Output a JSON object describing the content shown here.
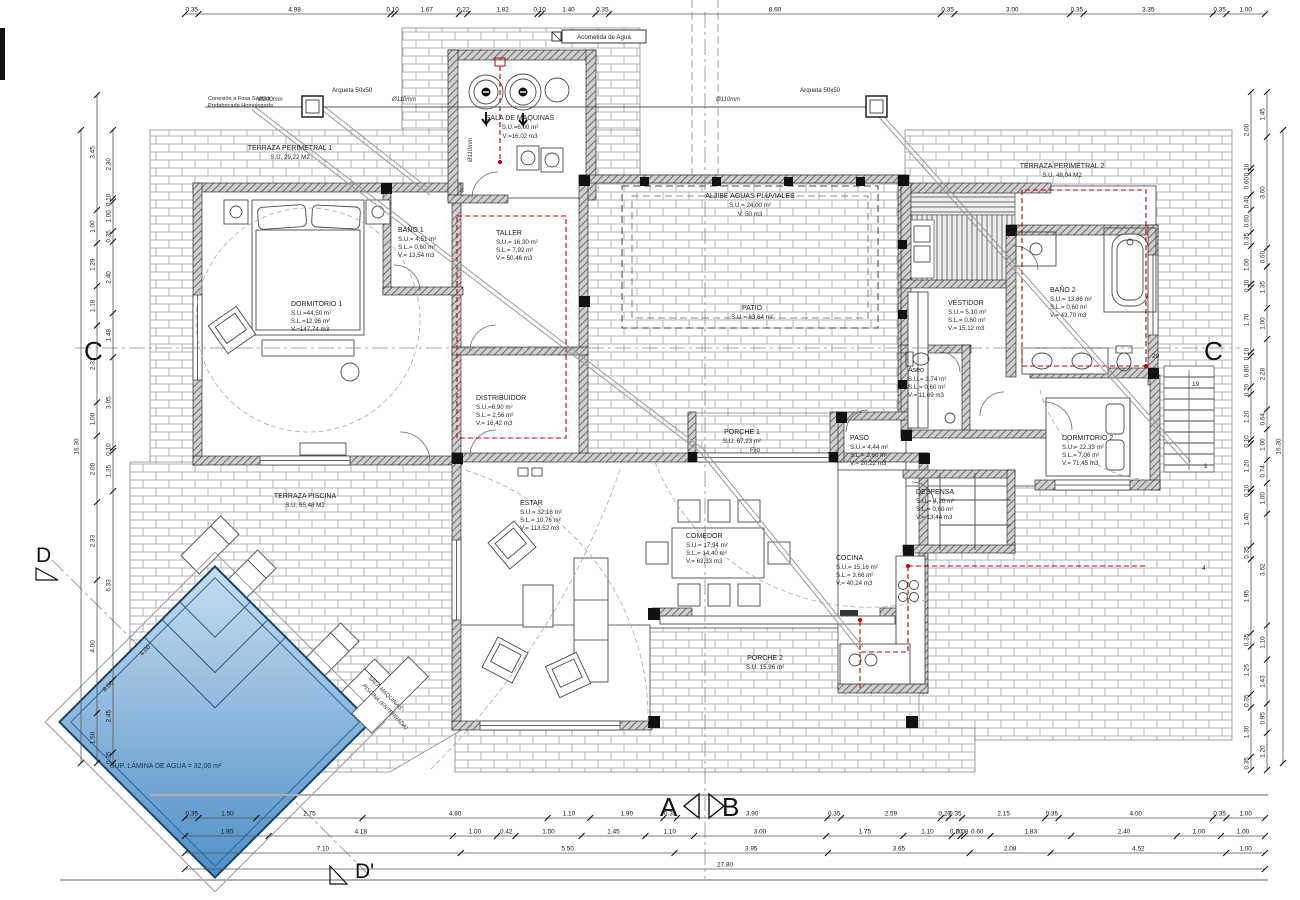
{
  "rooms": [
    {
      "name": "SALA DE MAQUINAS",
      "a": "S.U.=6,00 m²",
      "b": "V:=16,02 m3"
    },
    {
      "name": "TERRAZA PERIMETRAL 1",
      "a": "S.U. 29,22 M2"
    },
    {
      "name": "DORMITORIO 1",
      "a": "S.U.=44,50 m²",
      "b": "S.L.=12,96 m²",
      "c": "V.=147,74 m3"
    },
    {
      "name": "BAÑO 1",
      "a": "S.U.= 4,51 m²",
      "b": "S.L.= 0,60 m²",
      "c": "V.= 13,54 m3"
    },
    {
      "name": "TALLER",
      "a": "S.U.= 16,30 m²",
      "b": "S.L.= 7,92 m²",
      "c": "V.= 50,46 m3"
    },
    {
      "name": "ALJIBE AGUAS PLUVIALES",
      "a": "S.U.= 24,00 m²",
      "b": "V: 50 m3"
    },
    {
      "name": "PATIO",
      "a": "S.U.= 63,64 m²"
    },
    {
      "name": "DISTRIBUIDOR",
      "a": "S.U.=6,90 m²",
      "b": "S.L.= 2,56 m²",
      "c": "V.= 16,42 m3"
    },
    {
      "name": "VESTIDOR",
      "a": "S.U.= 5,10 m²",
      "b": "S.L.= 0,60 m²",
      "c": "V.= 15,12 m3"
    },
    {
      "name": "BAÑO 2",
      "a": "S.U.= 13,86 m²",
      "b": "S.L.= 0,60 m²",
      "c": "V.= 43,70 m3"
    },
    {
      "name": "Aseo",
      "a": "S.U.= 3,74 m²",
      "b": "S.L.= 0,60 m²",
      "c": "V.= 11,69 m3"
    },
    {
      "name": "PASO",
      "a": "S.U.= 4,44 m²",
      "b": "S.L.= 3,60 m²",
      "c": "V.= 20,22 m3"
    },
    {
      "name": "DESPENSA",
      "a": "S.U.= 4,20 m²",
      "b": "S.L.= 0,60 m²",
      "c": "V.= 13,44 m3"
    },
    {
      "name": "DORMITORIO 2",
      "a": "S.U.= 22,33 m²",
      "b": "S.L.= 7,06 m²",
      "c": "V.= 71,45 m3"
    },
    {
      "name": "COCINA",
      "a": "S.U.= 15,16 m²",
      "b": "S.L.= 3,66 m²",
      "c": "V.= 40,24 m3"
    },
    {
      "name": "ESTAR",
      "a": "S.U.= 32,16 m²",
      "b": "S.L.= 10,76 m²",
      "c": "V.= 113,52 m3"
    },
    {
      "name": "COMEDOR",
      "a": "S.U.= 17,94 m²",
      "b": "S.L.= 14,40 m²",
      "c": "V.= 63,33 m3"
    },
    {
      "name": "PORCHE 1",
      "a": "S.U. 67,23 m²"
    },
    {
      "name": "PORCHE 2",
      "a": "S.U. 15,96 m²"
    },
    {
      "name": "TERRAZA PERIMETRAL 2",
      "a": "S.U. 48,04 M2"
    },
    {
      "name": "TERRAZA PISCINA",
      "a": "S.U. 65,48 M2"
    }
  ],
  "annotations": {
    "acometida": "Acometida de Agua",
    "fosa1": "Conexión a Fosa Séptica",
    "fosa2": "Prefabricada Homologada",
    "arqueta": "Arqueta 50x50",
    "d200": "Ø200mm",
    "d110": "Ø110mm",
    "fijo": "Fijo",
    "lamina": "SUP. LÁMINA DE AGUA = 32,00 m²",
    "sala_piscina1": "SALA MAQUINAS",
    "sala_piscina2": "PISCINA (ENTERRADA)"
  },
  "markers": {
    "a": "A",
    "b": "B",
    "c": "C",
    "d": "D",
    "dp": "D'"
  },
  "stairs": [
    "20",
    "19",
    "1",
    "4"
  ],
  "colors": {
    "pool_dark": "#4d8fc7",
    "pool_light": "#c7ddf0",
    "red": "#c00000"
  },
  "dimensions": {
    "top": [
      "0.35",
      "4.98",
      "0.10",
      "1.67",
      "0.22",
      "1.82",
      "0.10",
      "1.40",
      "0.35",
      "8.60",
      "0.35",
      "3.00",
      "0.35",
      "3.35",
      "0.35",
      "1.00"
    ],
    "bottom1": [
      "0.35",
      "1.50",
      "2.75",
      "4.80",
      "1.10",
      "1.90",
      "0.35",
      "3.90",
      "0.35",
      "2.59",
      "0.20",
      "0.35",
      "2.15",
      "0.35",
      "4.00",
      "0.35",
      "1.00"
    ],
    "bottom2": [
      "1.90",
      "4.18",
      "1.00",
      "0.42",
      "1.50",
      "1.45",
      "1.10",
      "3.00",
      "1.75",
      "1.10",
      "0.20",
      "0.08",
      "0.60",
      "1.83",
      "2.40",
      "1.00",
      "1.00"
    ],
    "bottom3": [
      "7.10",
      "5.50",
      "3.95",
      "3.65",
      "2.08",
      "4.52",
      "1.00"
    ],
    "bottom4": [
      "27.80"
    ],
    "left_outer": [
      "16.30"
    ],
    "left_mid": [
      "3.45",
      "1.00",
      "1.29",
      "1.18",
      "2.31",
      "1.00",
      "2.00",
      "2.33",
      "4.00",
      "1.50"
    ],
    "left_inner": [
      "2.30",
      "0.10",
      "1.00",
      "0.35",
      "2.40",
      "1.48",
      "3.05",
      "0.10",
      "1.35",
      "6.33",
      "2.45",
      "0.35"
    ],
    "right_inner": [
      "2.00",
      "0.10",
      "0.60",
      "0.40",
      "0.60",
      "0.35",
      "1.00",
      "0.10",
      "1.70",
      "0.10",
      "0.80",
      "0.20",
      "1.20",
      "0.10",
      "1.20",
      "0.10",
      "1.40",
      "0.35",
      "1.95",
      "0.35",
      "1.25",
      "0.35",
      "1.30",
      "0.35"
    ],
    "right_mid": [
      "1.45",
      "3.60",
      "0.60",
      "1.35",
      "1.00",
      "2.28",
      "0.64",
      "1.00",
      "0.74",
      "1.00",
      "3.62",
      "1.10",
      "1.43",
      "0.95",
      "1.20"
    ],
    "right_outer": [
      "16.30"
    ],
    "pool": [
      "8.00",
      "4.00"
    ]
  }
}
